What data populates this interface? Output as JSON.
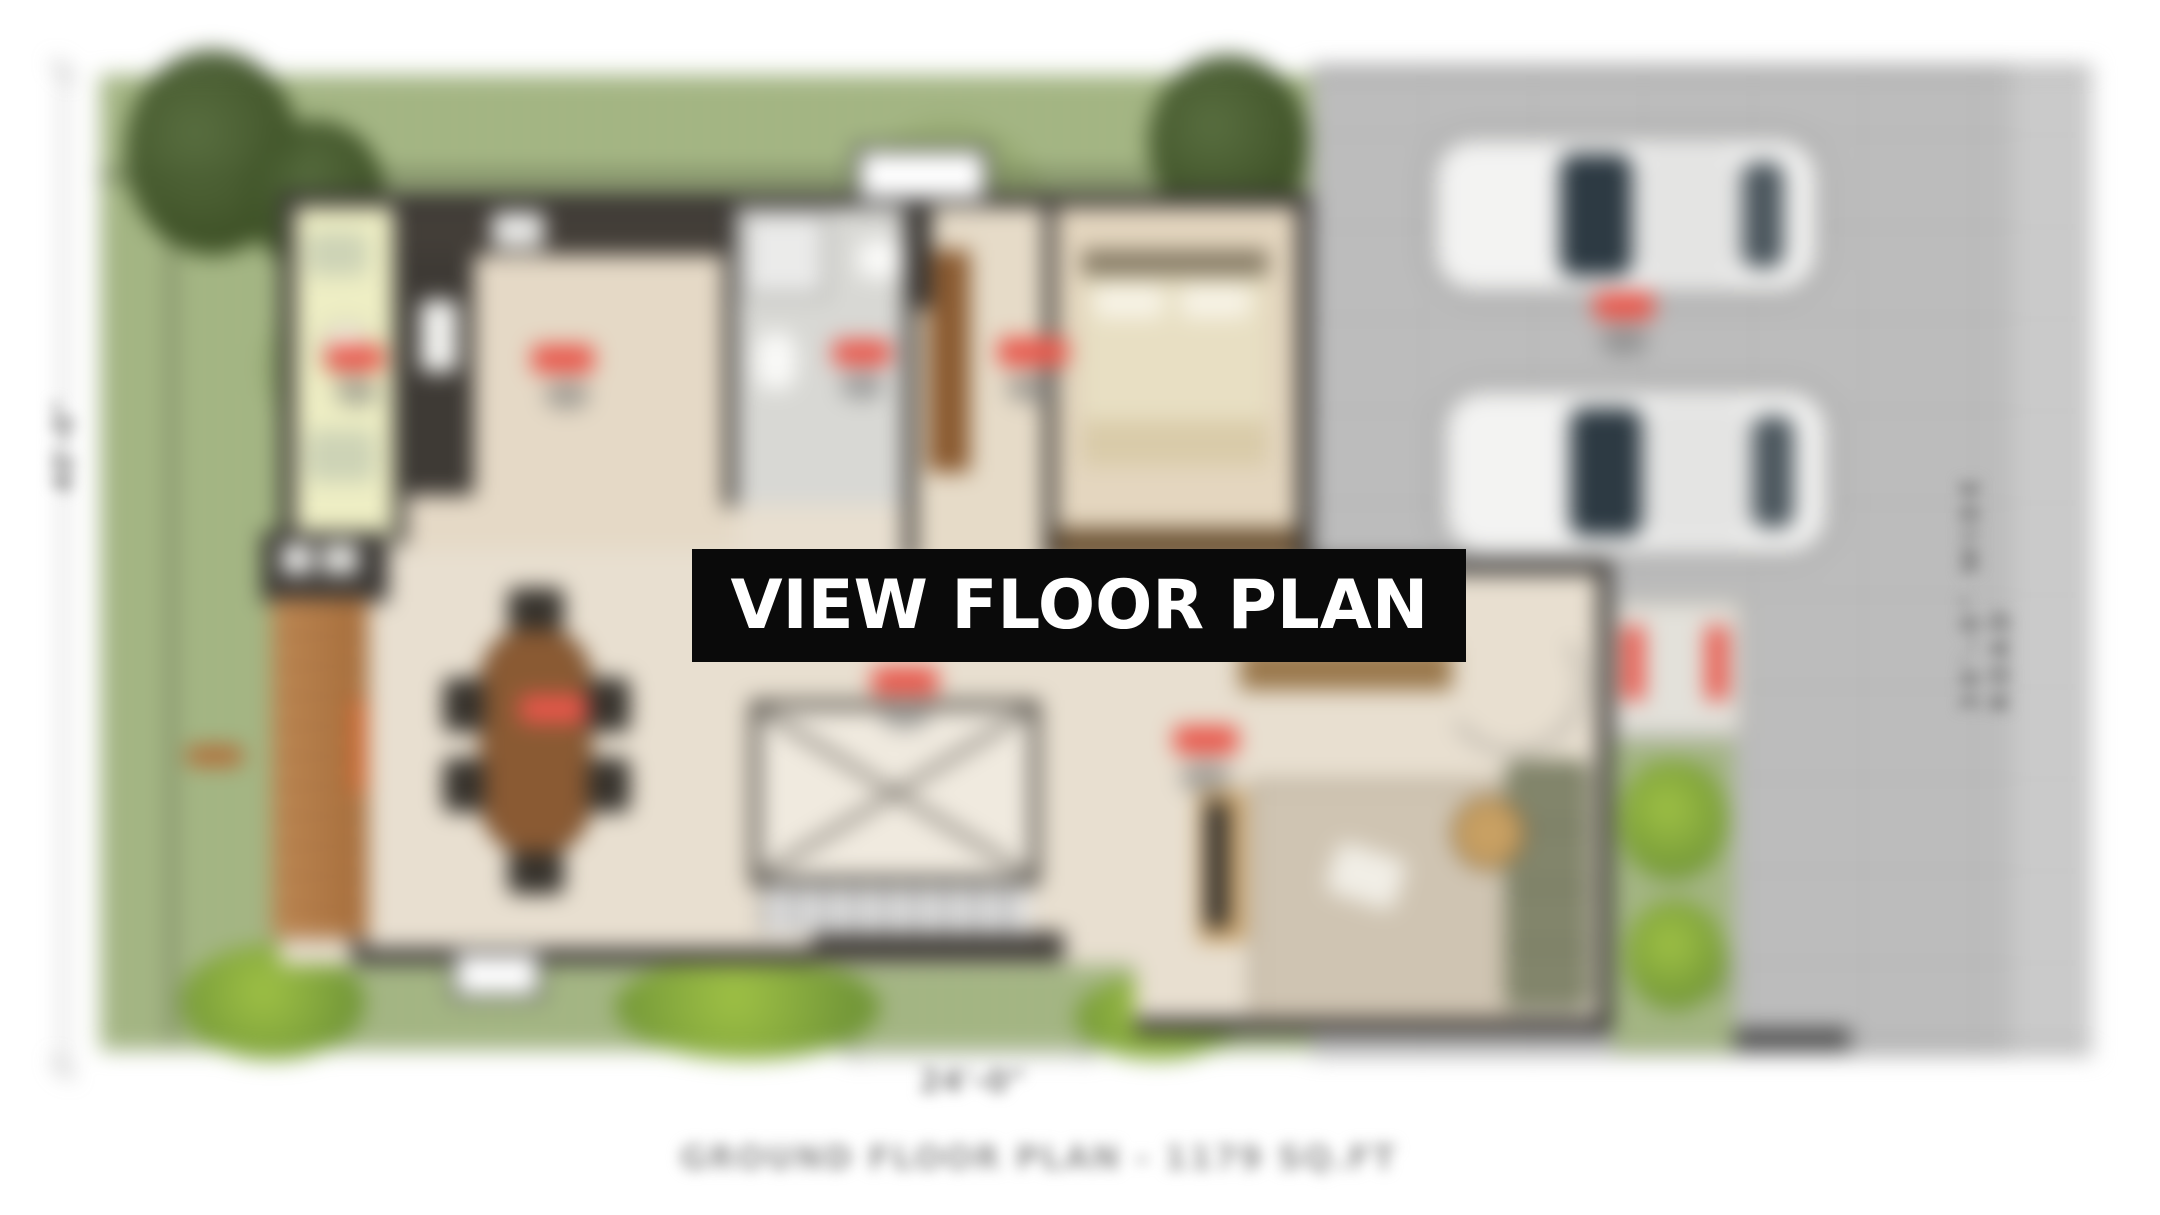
{
  "banner": {
    "label": "VIEW FLOOR PLAN"
  },
  "caption": {
    "text": "GROUND FLOOR PLAN - 1179 SQ.FT"
  },
  "road": {
    "label": "30'-0\" WIDE ROAD"
  },
  "dimensions": {
    "left": "40'-0\"",
    "bottom": "24'-0\""
  },
  "colors": {
    "banner_bg": "#0a0a0a",
    "banner_text": "#ffffff",
    "garden_green": "#a3b581",
    "road_grey": "#bcbcbc",
    "floor_beige": "#e8dfd0",
    "wall_dark": "#3a3734",
    "deck_wood": "#b57b48",
    "porch_yellow": "#eeeec4",
    "label_red": "#e8564a"
  }
}
